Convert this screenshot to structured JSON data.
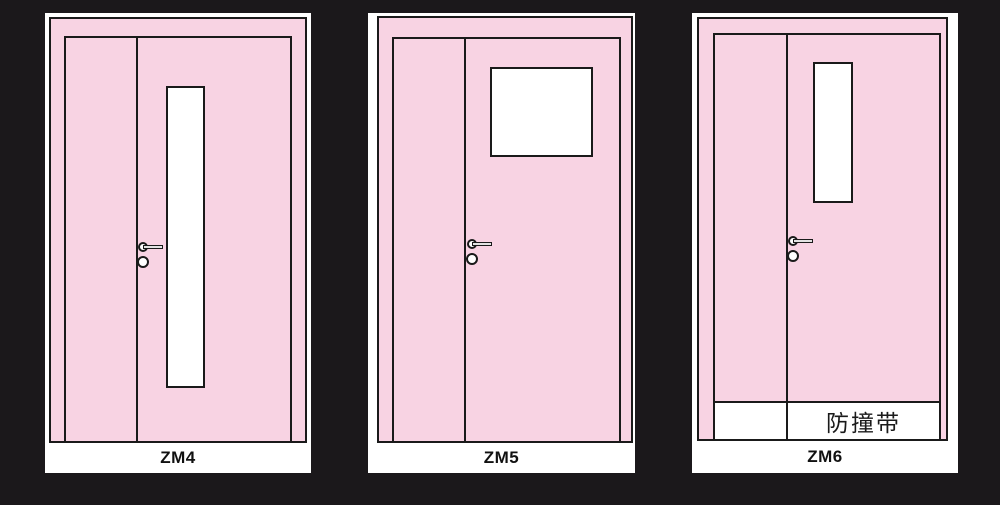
{
  "colors": {
    "background": "#1b181b",
    "door_fill": "#f8d3e3",
    "outline": "#1a1a1a",
    "card": "#ffffff"
  },
  "doors": [
    {
      "label": "ZM4"
    },
    {
      "label": "ZM5"
    },
    {
      "label": "ZM6",
      "band_label": "防撞带"
    }
  ]
}
